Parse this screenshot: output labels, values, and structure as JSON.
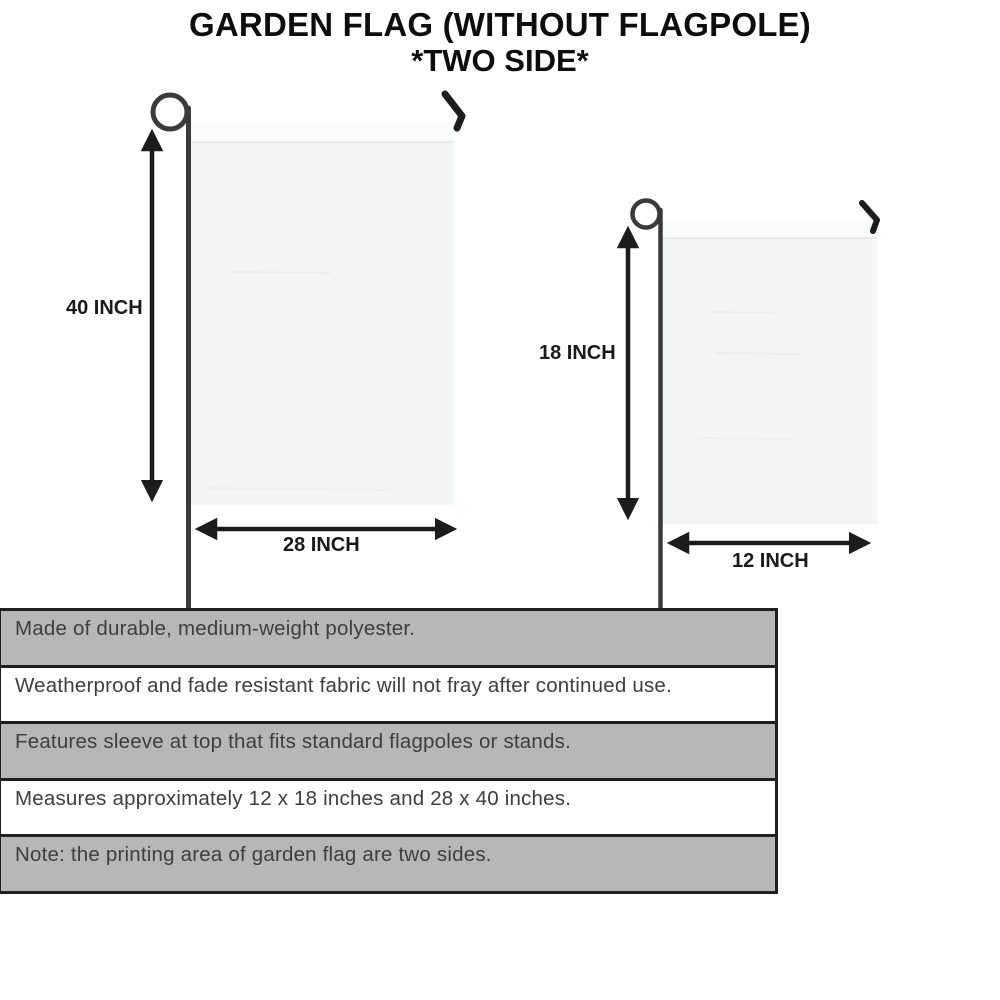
{
  "title": {
    "line1": "GARDEN FLAG (WITHOUT FLAGPOLE)",
    "line2": "*TWO SIDE*"
  },
  "diagram": {
    "large_flag": {
      "name": "large garden flag on pole",
      "height_label": "40 INCH",
      "width_label": "28 INCH"
    },
    "small_flag": {
      "name": "small garden flag on pole",
      "height_label": "18 INCH",
      "width_label": "12 INCH"
    }
  },
  "features": {
    "rows": [
      {
        "text": "Made of durable, medium-weight polyester.",
        "shaded": true
      },
      {
        "text": "Weatherproof and fade resistant fabric will not fray after continued use.",
        "shaded": false
      },
      {
        "text": "Features sleeve at top that fits standard flagpoles or stands.",
        "shaded": true
      },
      {
        "text": "Measures approximately 12 x 18 inches and 28 x 40 inches.",
        "shaded": false
      },
      {
        "text": "Note: the printing area of garden flag are two sides.",
        "shaded": true
      }
    ]
  },
  "colors": {
    "row_shaded": "#b7b7b7",
    "row_plain": "#ffffff",
    "panel_border": "#1f1f1f",
    "pole": "#3a3a3a",
    "flag_fill": "#f4f5f5",
    "arrow": "#1c1c1c",
    "title_text": "#0d0d0d"
  }
}
